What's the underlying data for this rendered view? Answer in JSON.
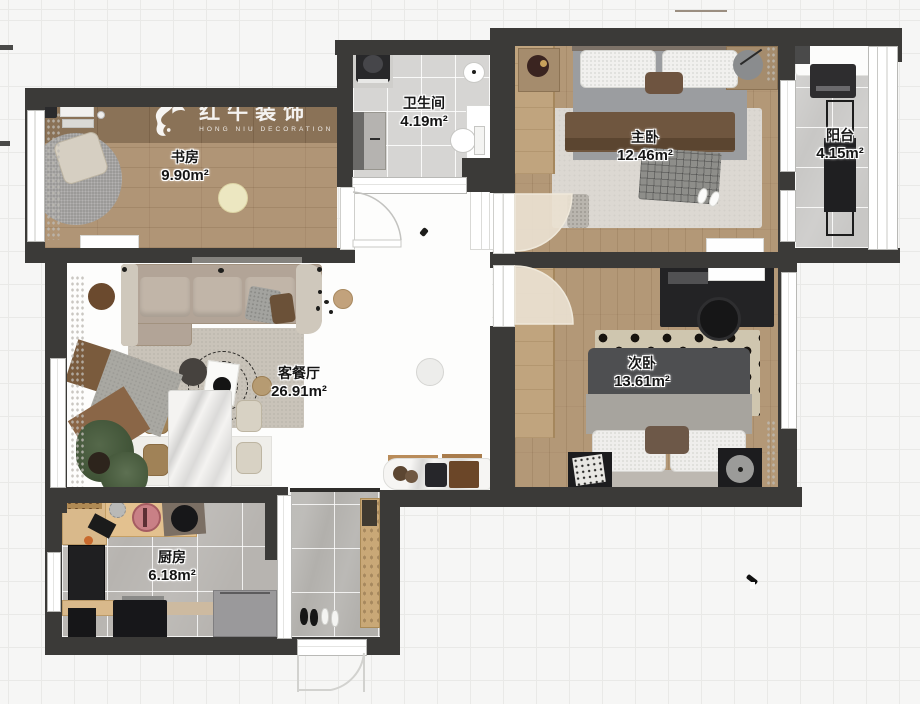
{
  "meta": {
    "kind": "residential-floor-plan"
  },
  "brand": {
    "name_cn": "红牛装饰",
    "name_en": "HONG NIU DECORATION",
    "registered_mark": "®",
    "bull_icon": "bull-swoosh-logo"
  },
  "rooms": [
    {
      "id": "study",
      "name": "书房",
      "area": "9.90m²"
    },
    {
      "id": "bathroom",
      "name": "卫生间",
      "area": "4.19m²"
    },
    {
      "id": "master-bedroom",
      "name": "主卧",
      "area": "12.46m²"
    },
    {
      "id": "balcony",
      "name": "阳台",
      "area": "4.15m²"
    },
    {
      "id": "living-dining",
      "name": "客餐厅",
      "area": "26.91m²"
    },
    {
      "id": "second-bedroom",
      "name": "次卧",
      "area": "13.61m²"
    },
    {
      "id": "kitchen",
      "name": "厨房",
      "area": "6.18m²"
    }
  ],
  "palette": {
    "wall": "#3b3a38",
    "wood_floor": "#b29878",
    "logo_band": "#8a7257",
    "bath_tile": "#d6d5d3",
    "kitchen_tile": "#b7b4b0",
    "balcony_tile": "#c8c7c5",
    "grid_line": "#e9e9e7",
    "background": "#f6f6f5"
  }
}
